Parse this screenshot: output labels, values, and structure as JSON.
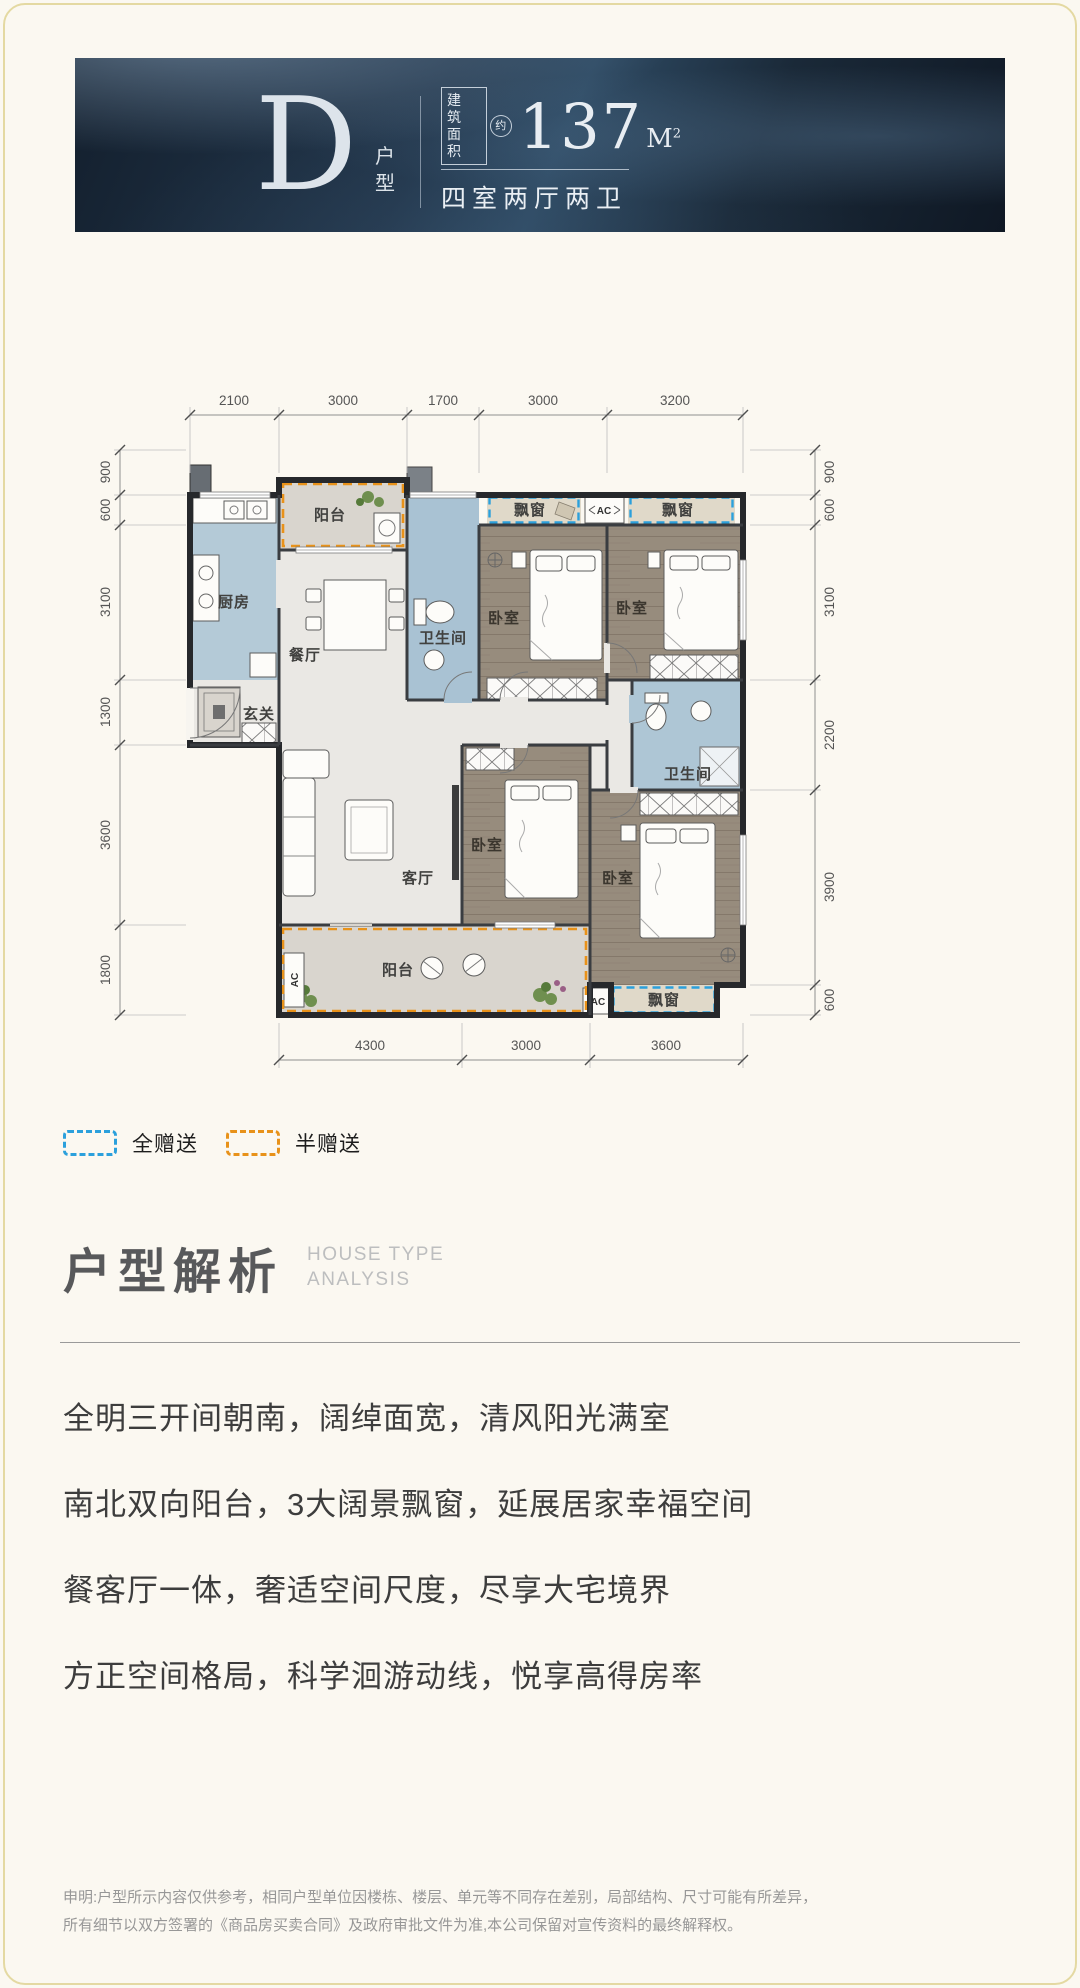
{
  "header": {
    "type_letter": "D",
    "type_label": "户型",
    "area_box_line1": "建筑",
    "area_box_line2": "面积",
    "area_approx": "约",
    "area_value": "137",
    "area_unit": "M",
    "area_sup": "2",
    "layout_text": "四室两厅两卫"
  },
  "plan": {
    "dims_top": [
      "2100",
      "3000",
      "1700",
      "3000",
      "3200"
    ],
    "dims_bottom": [
      "4300",
      "3000",
      "3600"
    ],
    "dims_left": [
      "900",
      "600",
      "3100",
      "1300",
      "3600",
      "1800"
    ],
    "dims_right": [
      "900",
      "600",
      "3100",
      "2200",
      "3900",
      "600"
    ],
    "rooms": {
      "balcony": "阳台",
      "kitchen": "厨房",
      "dining": "餐厅",
      "bathroom": "卫生间",
      "bedroom": "卧室",
      "entry": "玄关",
      "living": "客厅",
      "bay_window": "飘窗",
      "ac": "AC"
    }
  },
  "legend": {
    "full": {
      "label": "全赠送",
      "color": "#2ba0dc"
    },
    "half": {
      "label": "半赠送",
      "color": "#e8921a"
    }
  },
  "analysis": {
    "title": "户型解析",
    "subtitle_line1": "HOUSE TYPE",
    "subtitle_line2": "ANALYSIS",
    "points": [
      "全明三开间朝南，阔绰面宽，清风阳光满室",
      "南北双向阳台，3大阔景飘窗，延展居家幸福空间",
      "餐客厅一体，奢适空间尺度，尽享大宅境界",
      "方正空间格局，科学洄游动线，悦享高得房率"
    ]
  },
  "disclaimer": {
    "line1": "申明:户型所示内容仅供参考，相同户型单位因楼栋、楼层、单元等不同存在差别，局部结构、尺寸可能有所差异，",
    "line2": "所有细节以双方签署的《商品房买卖合同》及政府审批文件为准,本公司保留对宣传资料的最终解释权。"
  },
  "colors": {
    "banner_bg": "#22364b",
    "accent_blue": "#2ba0dc",
    "accent_orange": "#e8921a",
    "kitchen_bath_floor": "#b0c8d7",
    "bedroom_floor": "#978c7d",
    "marble_floor": "#eae8e4"
  }
}
